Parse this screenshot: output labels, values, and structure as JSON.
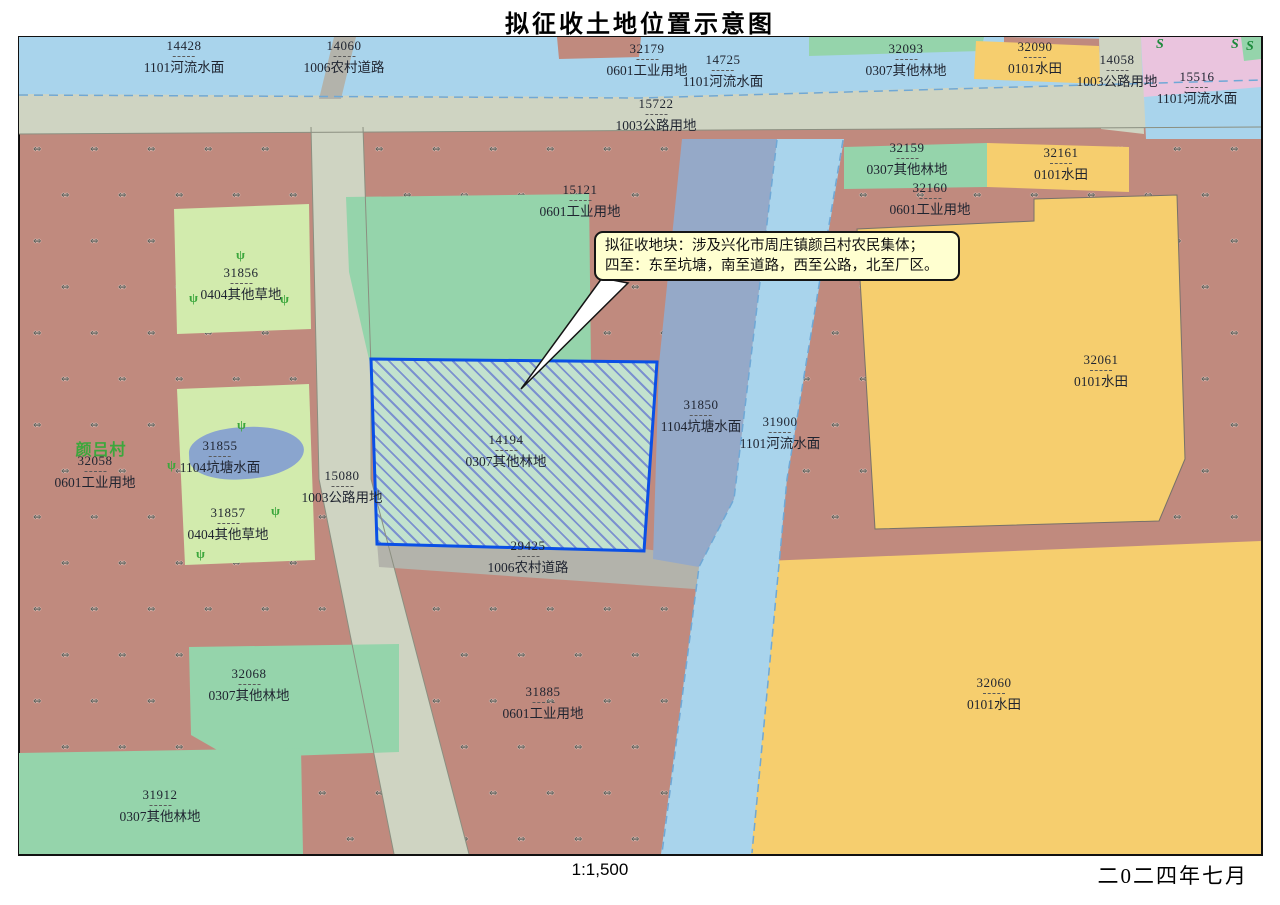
{
  "title": "拟征收土地位置示意图",
  "footer": {
    "scale": "1:1,500",
    "date": "二0二四年七月"
  },
  "village_label": "颜吕村",
  "callout": {
    "line1": "拟征收地块：涉及兴化市周庄镇颜吕村农民集体；",
    "line2": "四至：东至坑塘，南至道路，西至公路，北至厂区。"
  },
  "highlight_parcel": {
    "code": "14194",
    "landuse": "0307其他林地"
  },
  "colors": {
    "river_water": "#A9D4EC",
    "road_land": "#CFD4C2",
    "rural_road": "#B3B3AB",
    "industrial": "#C08A7E",
    "paddy_field": "#F6CE6E",
    "forest_land": "#95D4AB",
    "grass_land": "#D2EBAD",
    "pond_water": "#95A9C8",
    "pond_small": "#8AA5CE",
    "pink_area": "#EAC4DE",
    "highlight_fill": "#C2E2CE",
    "highlight_hatch": "#7B91CF",
    "highlight_border": "#0A50E6",
    "callout_bg": "#FFFFD0",
    "label_text": "#1F2430",
    "village_text": "#3CA73C"
  },
  "parcels": [
    {
      "code": "14428",
      "landuse": "1101河流水面",
      "x": 165,
      "y": 2
    },
    {
      "code": "14060",
      "landuse": "1006农村道路",
      "x": 325,
      "y": 2
    },
    {
      "code": "32179",
      "landuse": "0601工业用地",
      "x": 628,
      "y": 5
    },
    {
      "code": "14725",
      "landuse": "1101河流水面",
      "x": 704,
      "y": 16
    },
    {
      "code": "15722",
      "landuse": "1003公路用地",
      "x": 637,
      "y": 60
    },
    {
      "code": "32093",
      "landuse": "0307其他林地",
      "x": 887,
      "y": 5
    },
    {
      "code": "32090",
      "landuse": "0101水田",
      "x": 1016,
      "y": 3
    },
    {
      "code": "14058",
      "landuse": "1003公路用地",
      "x": 1098,
      "y": 16
    },
    {
      "code": "15516",
      "landuse": "1101河流水面",
      "x": 1178,
      "y": 33
    },
    {
      "code": "32159",
      "landuse": "0307其他林地",
      "x": 888,
      "y": 104
    },
    {
      "code": "32161",
      "landuse": "0101水田",
      "x": 1042,
      "y": 109
    },
    {
      "code": "32160",
      "landuse": "0601工业用地",
      "x": 911,
      "y": 144
    },
    {
      "code": "15121",
      "landuse": "0601工业用地",
      "x": 561,
      "y": 146
    },
    {
      "code": "31856",
      "landuse": "0404其他草地",
      "x": 222,
      "y": 229
    },
    {
      "code": "32058",
      "landuse": "0601工业用地",
      "x": 76,
      "y": 417
    },
    {
      "code": "31855",
      "landuse": "1104坑塘水面",
      "x": 201,
      "y": 402
    },
    {
      "code": "31857",
      "landuse": "0404其他草地",
      "x": 209,
      "y": 469
    },
    {
      "code": "15080",
      "landuse": "1003公路用地",
      "x": 323,
      "y": 432
    },
    {
      "code": "14194",
      "landuse": "0307其他林地",
      "x": 487,
      "y": 396
    },
    {
      "code": "29425",
      "landuse": "1006农村道路",
      "x": 509,
      "y": 502
    },
    {
      "code": "31850",
      "landuse": "1104坑塘水面",
      "x": 682,
      "y": 361
    },
    {
      "code": "31900",
      "landuse": "1101河流水面",
      "x": 761,
      "y": 378
    },
    {
      "code": "32061",
      "landuse": "0101水田",
      "x": 1082,
      "y": 316
    },
    {
      "code": "32068",
      "landuse": "0307其他林地",
      "x": 230,
      "y": 630
    },
    {
      "code": "31885",
      "landuse": "0601工业用地",
      "x": 524,
      "y": 648
    },
    {
      "code": "31912",
      "landuse": "0307其他林地",
      "x": 141,
      "y": 751
    },
    {
      "code": "32060",
      "landuse": "0101水田",
      "x": 975,
      "y": 639
    }
  ]
}
